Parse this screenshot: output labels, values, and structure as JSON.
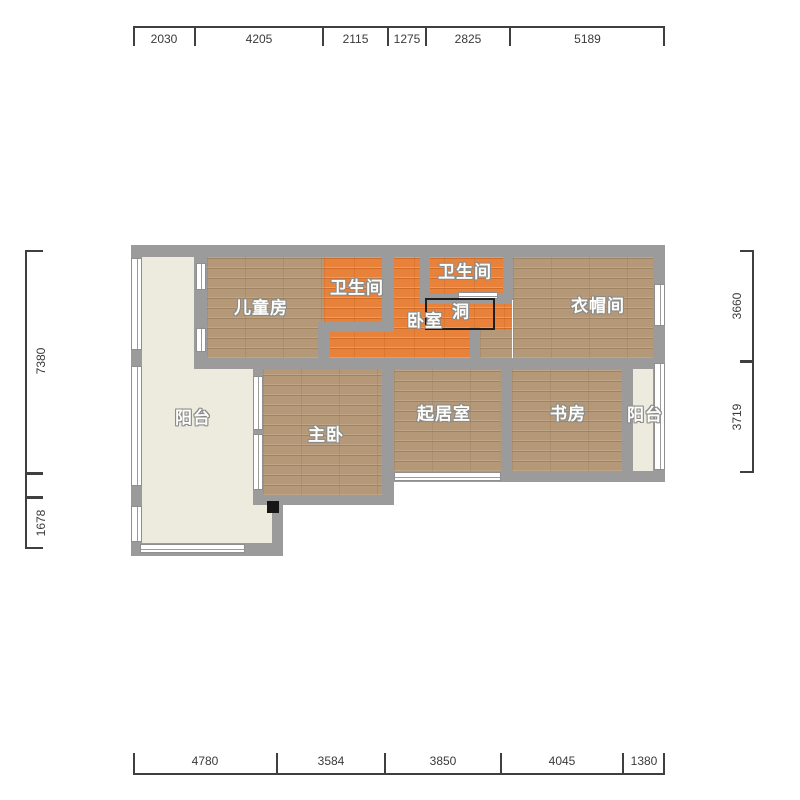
{
  "dimensions": {
    "top": [
      "2030",
      "4205",
      "2115",
      "1275",
      "2825",
      "5189"
    ],
    "bottom": [
      "4780",
      "3584",
      "3850",
      "4045",
      "1380"
    ],
    "left": [
      "7380",
      "",
      "1678"
    ],
    "right": [
      "3660",
      "3719"
    ]
  },
  "rooms": {
    "children_room": "儿童房",
    "bathroom_left": "卫生间",
    "bathroom_right": "卫生间",
    "bedroom": "卧室",
    "hole": "洞",
    "cloakroom": "衣帽间",
    "balcony_left": "阳台",
    "master_bedroom": "主卧",
    "living_room": "起居室",
    "study": "书房",
    "balcony_right": "阳台"
  },
  "colors": {
    "wall": "#9b9b9b",
    "wood_floor": "#b49878",
    "orange_floor": "#e8823a",
    "balcony_floor": "#edeade",
    "dimension_text": "#3a3a3a",
    "room_label_text": "#fdfdfa"
  }
}
